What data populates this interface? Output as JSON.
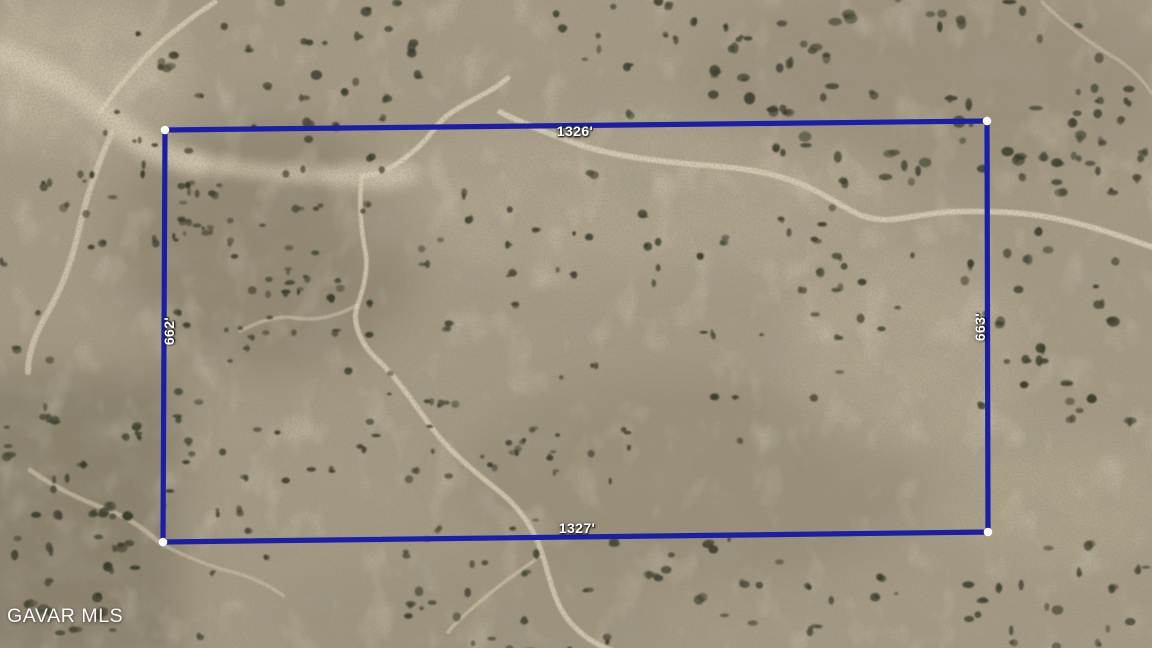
{
  "map": {
    "type": "aerial-parcel-view",
    "terrain": "desert scrub with dirt trails"
  },
  "parcel": {
    "top_label": "1326'",
    "bottom_label": "1327'",
    "left_label": "662'",
    "right_label": "663'",
    "boundary_color": "#1A1FA6",
    "corner_marker_color": "#FFFFFF",
    "label_color": "#FFFFFF",
    "corners": [
      [
        165,
        130
      ],
      [
        987,
        121
      ],
      [
        988,
        532
      ],
      [
        163,
        542
      ]
    ]
  },
  "watermark": {
    "text": "GAVAR MLS"
  }
}
